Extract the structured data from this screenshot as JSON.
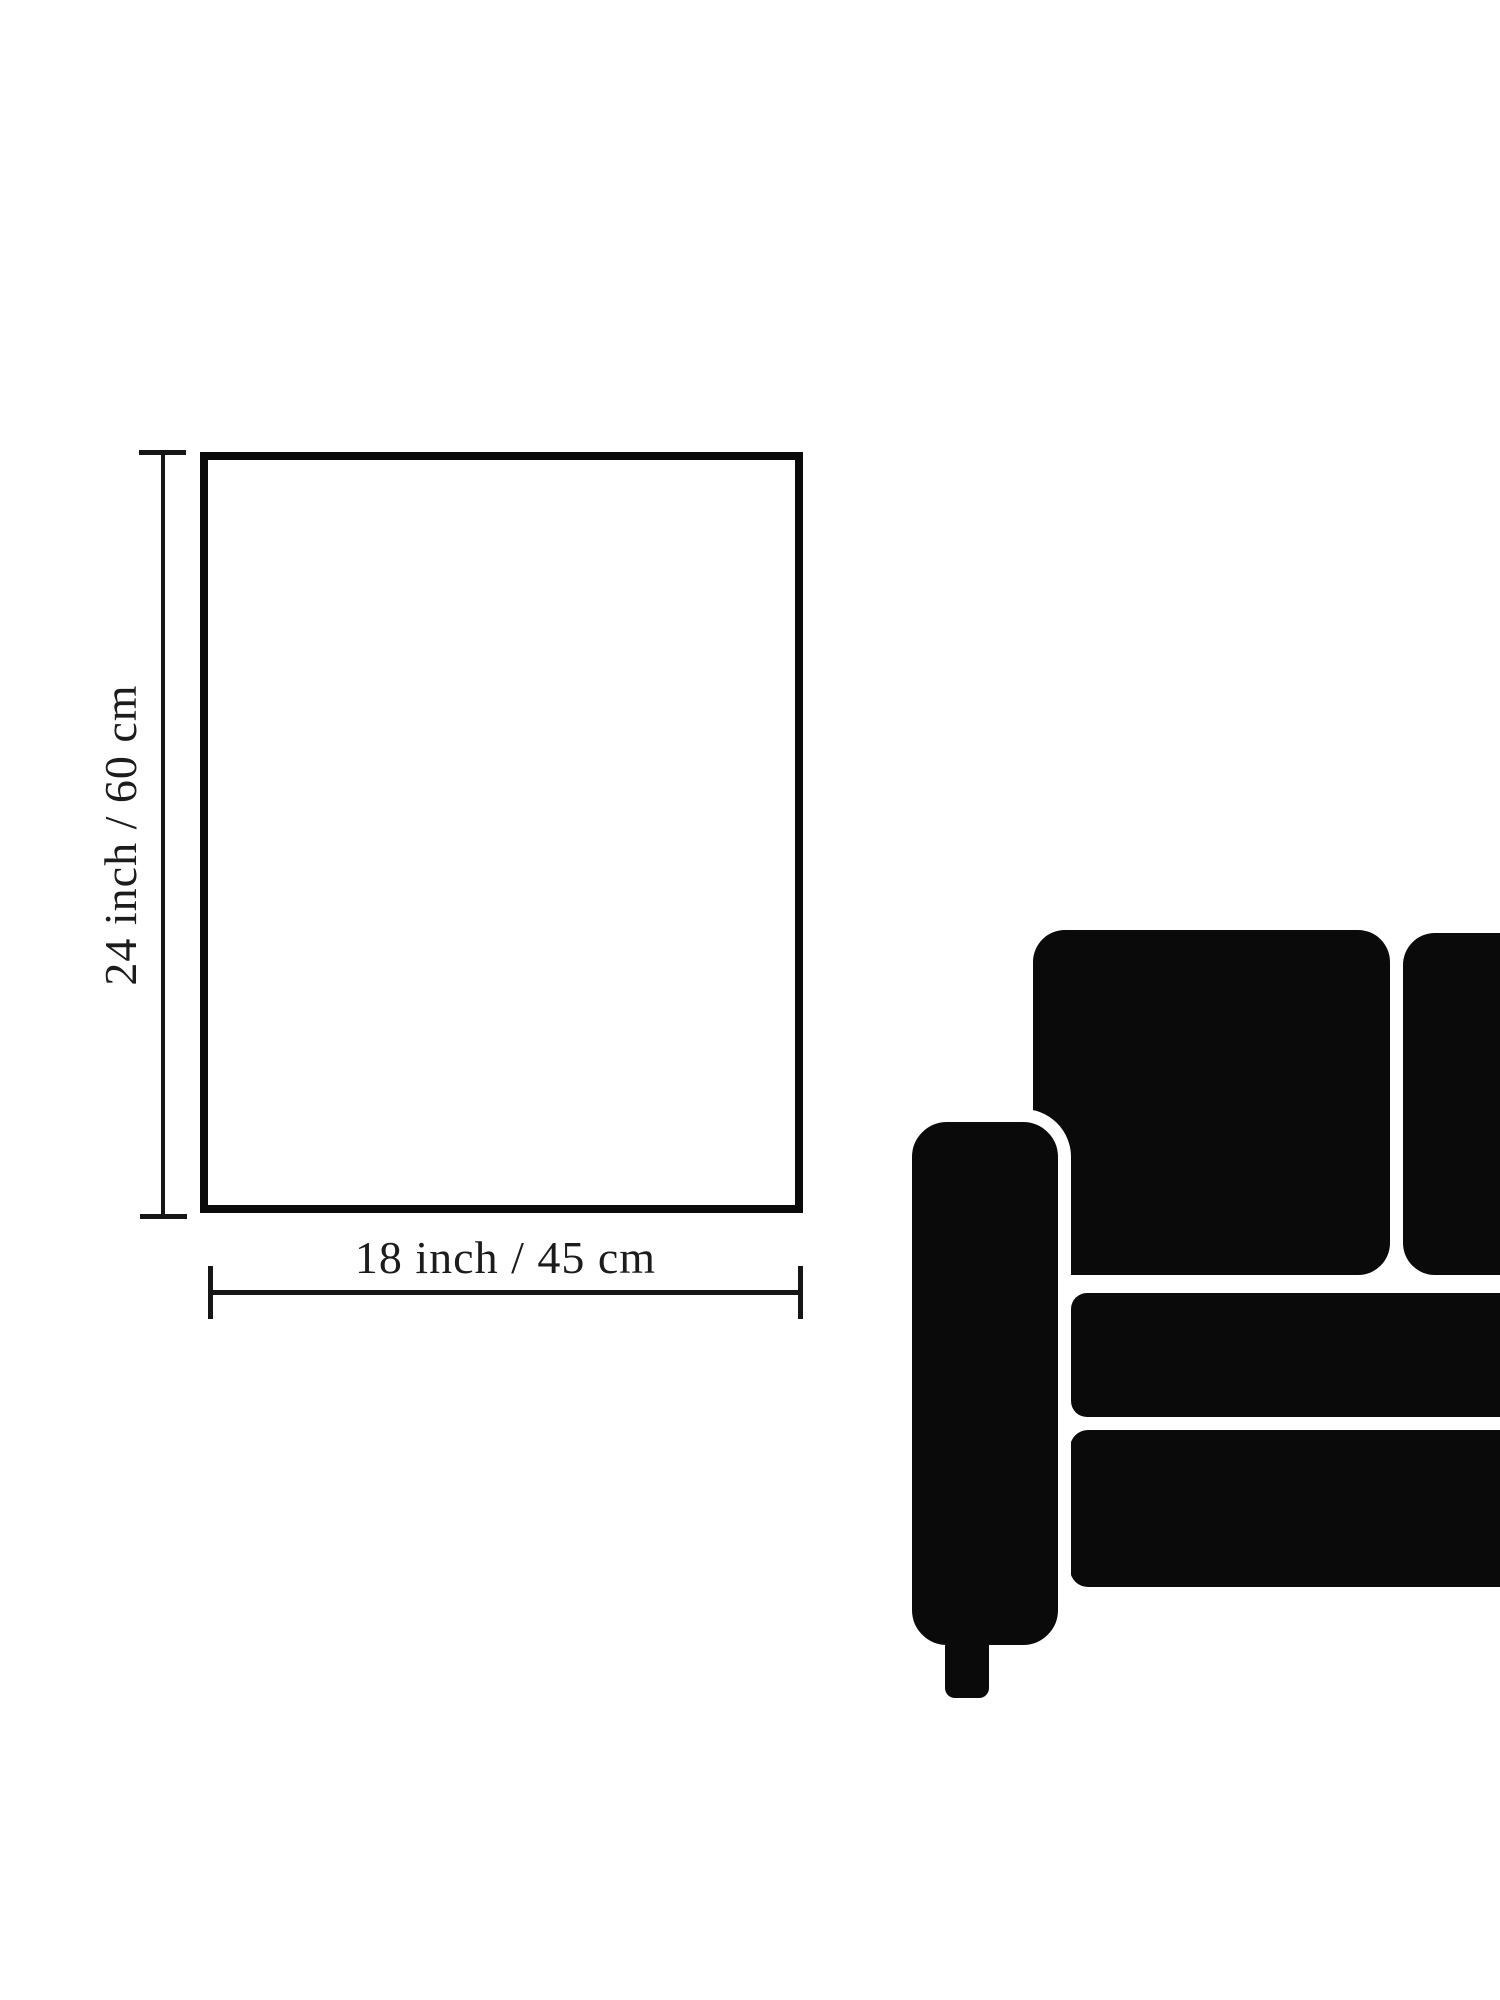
{
  "canvas": {
    "width_px": 1500,
    "height_px": 2000,
    "background_color": "#ffffff",
    "ink_color": "#0a0a0a",
    "text_color": "#1c1c1c"
  },
  "dimension_diagram": {
    "vertical_label": "24 inch / 60 cm",
    "horizontal_label": "18 inch / 45 cm"
  },
  "icons": {
    "sofa_icon": "sofa-silhouette-partial-left-armrest-two-back-cushions-two-seat-bars"
  }
}
